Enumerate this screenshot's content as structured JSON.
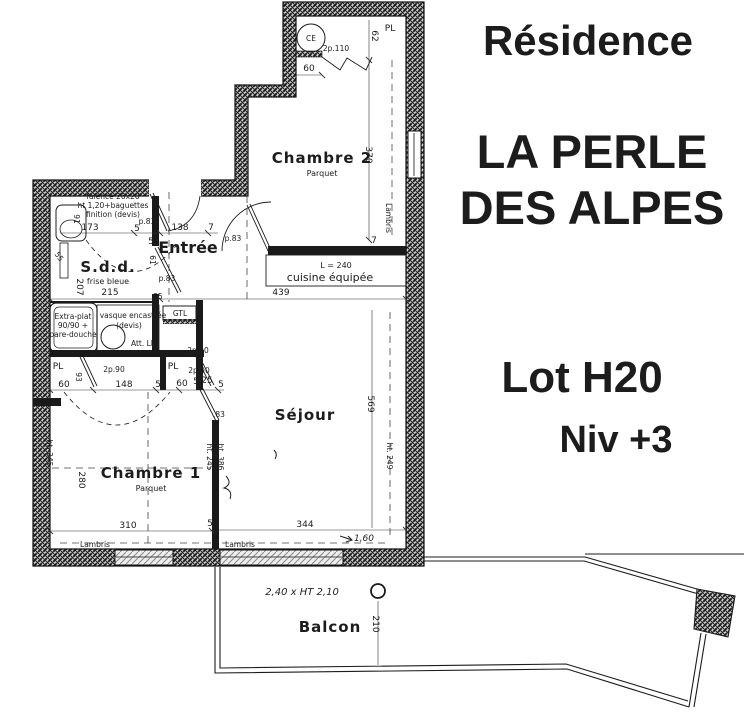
{
  "title": {
    "residence": "Résidence",
    "name1": "LA PERLE",
    "name2": "DES ALPES",
    "lot": "Lot H20",
    "niv": "Niv +3",
    "color": "#1b1bce"
  },
  "rooms": {
    "chambre2": {
      "name": "Chambre 2",
      "floor": "Parquet"
    },
    "entree": {
      "name": "Entrée"
    },
    "sdd": {
      "name": "S.d.d.",
      "note": "frise bleue"
    },
    "sejour": {
      "name": "Séjour"
    },
    "chambre1": {
      "name": "Chambre 1",
      "floor": "Parquet"
    },
    "cuisine": {
      "name": "cuisine équipée",
      "length": "L = 240"
    },
    "balcon": {
      "name": "Balcon"
    }
  },
  "labels": {
    "pl": "PL",
    "ce": "CE",
    "gtl": "GTL",
    "attll": "Att. LL",
    "lambris": "Lambris",
    "d2p90": "2p.90",
    "d2p110": "2p.110",
    "faience1": "faïence 20x20",
    "faience2": "ht 1,20+baguettes",
    "faience3": "finition (devis)",
    "shower1": "Extra-plat",
    "shower2": "90/90 +",
    "shower3": "pare-douche",
    "vasque1": "vasque encastrée",
    "vasque2": "(devis)",
    "frise": "frise bleue",
    "hand_bay": "2,40 x HT 2,10",
    "hand160": "1,60"
  },
  "dims": {
    "d5": "5",
    "d7": "7",
    "d25": "25",
    "d55": "55",
    "d60": "60",
    "d61": "61",
    "d62": "62",
    "d91": "91",
    "d93": "93",
    "d110": "110",
    "d138": "138",
    "d148": "148",
    "d173": "173",
    "d207": "207",
    "d210": "210",
    "d215": "215",
    "d280": "280",
    "d310": "310",
    "d344": "344",
    "d370": "370",
    "d439": "439",
    "d569": "569",
    "h245": "ht. 245",
    "h249": "ht. 249",
    "h386": "ht. 386",
    "p83": "p.83",
    "p83s": ".83"
  }
}
